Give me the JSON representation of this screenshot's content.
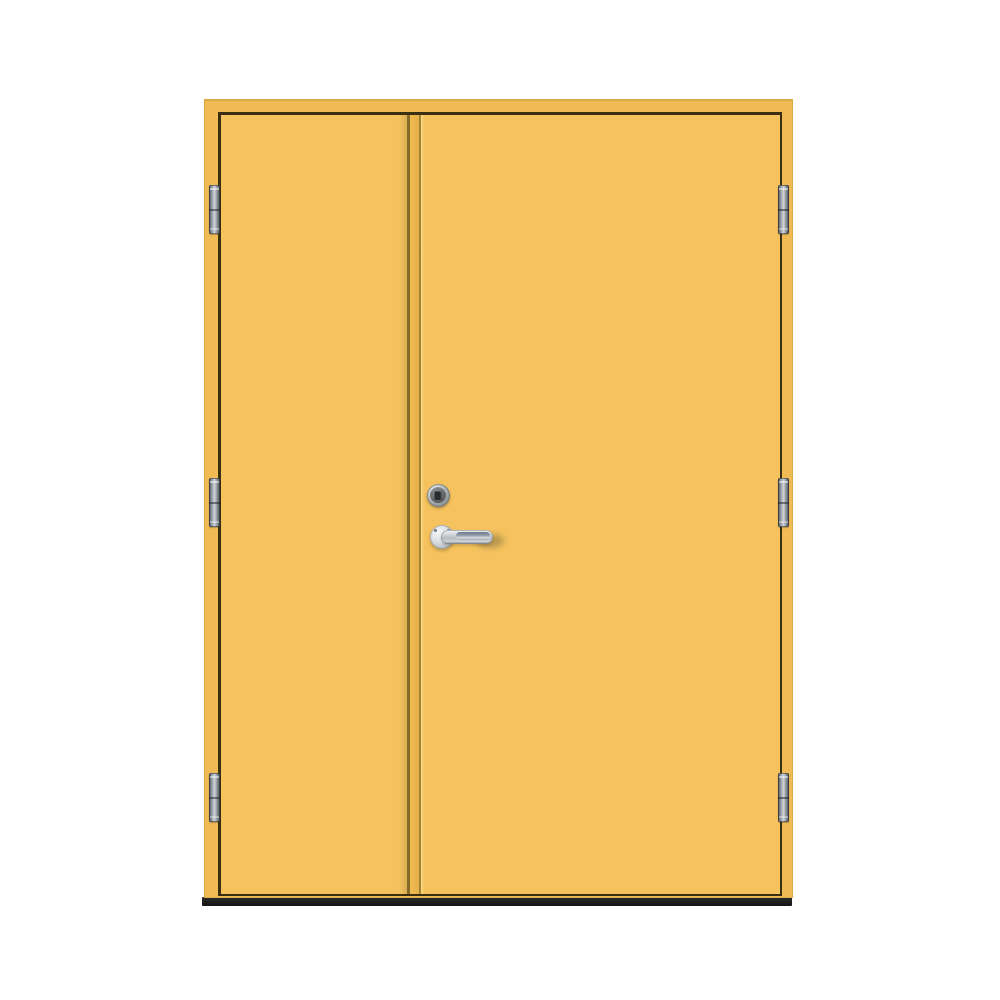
{
  "product": {
    "name": "double-exterior-door",
    "description": "Yellow double front door with frame, six barrel hinges, chrome lock cylinder and lever handle over a dark threshold on a white background",
    "leaf_count": 2,
    "visible_text": ""
  },
  "colors": {
    "background": "#FFFFFF",
    "door_leaf": "#F5C25E",
    "door_frame": "#F0BB54",
    "frame_edge": "#DCAB43",
    "gap_shadow": "#3A300F",
    "divider_line": "#6E5A1E",
    "divider_strip_a": "#F0BA51",
    "divider_strip_b": "#E7AF47",
    "divider_highlight": "#FBDC86",
    "threshold": "#1E1E1E",
    "chrome_light": "#F2F4F5",
    "chrome_mid": "#B6BCC1",
    "chrome_dark": "#7F868C"
  },
  "hardware": {
    "hinge_count": 6,
    "hinge_x": {
      "left": 209,
      "right": 778
    },
    "hinges": [
      {
        "side": "left",
        "y": 185
      },
      {
        "side": "left",
        "y": 478
      },
      {
        "side": "left",
        "y": 773
      },
      {
        "side": "right",
        "y": 185
      },
      {
        "side": "right",
        "y": 478
      },
      {
        "side": "right",
        "y": 773
      }
    ],
    "items": [
      "lock-cylinder",
      "lever-handle",
      "handle-rosette",
      "threshold"
    ]
  }
}
